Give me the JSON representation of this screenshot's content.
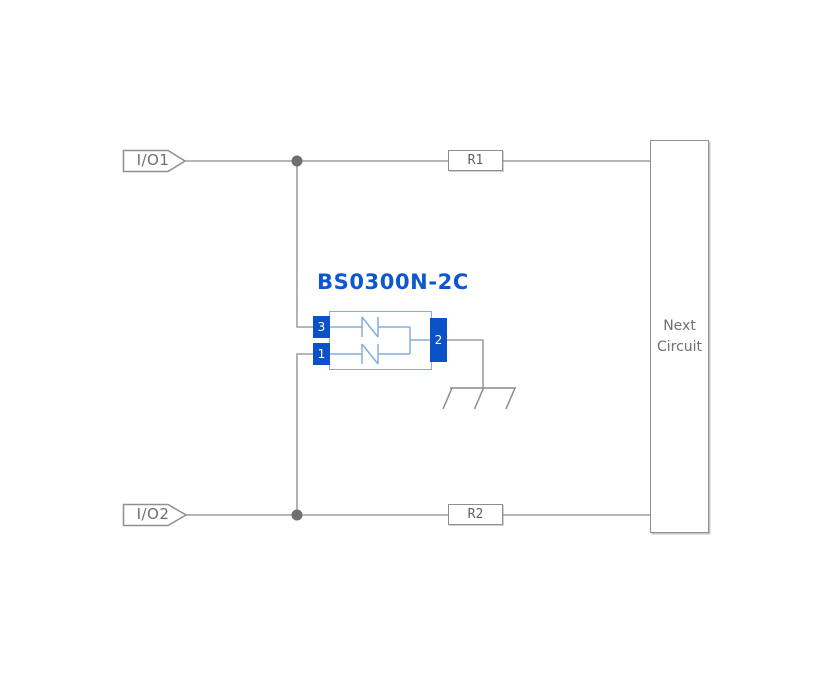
{
  "diagram": {
    "io_tags": [
      {
        "label": "I/O1"
      },
      {
        "label": "I/O2"
      }
    ],
    "resistors": [
      {
        "label": "R1"
      },
      {
        "label": "R2"
      }
    ],
    "next_circuit": {
      "line1": "Next",
      "line2": "Circuit"
    },
    "component": {
      "title": "BS0300N-2C",
      "pins": [
        {
          "number": "3"
        },
        {
          "number": "1"
        },
        {
          "number": "2"
        }
      ]
    },
    "colors": {
      "wire_gray": "#9e9e9e",
      "junction_dot_gray": "#6f6f6f",
      "outline_gray": "#8f8f8f",
      "label_gray": "#6e6e6e",
      "title_blue": "#0d57d1",
      "body_outline_blue": "#85aede",
      "pin_fill_blue": "#0b51c8",
      "pin_text": "#ffffff"
    }
  }
}
